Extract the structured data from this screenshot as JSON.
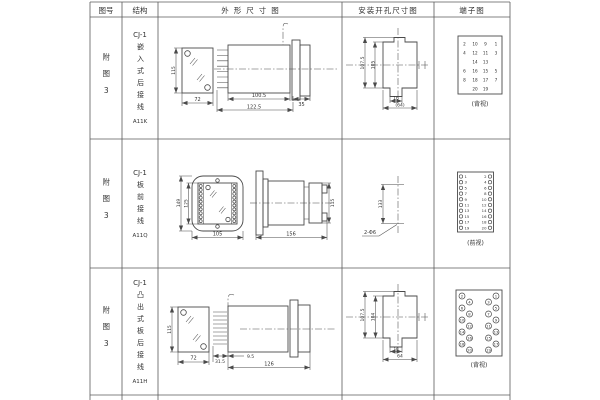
{
  "meta": {
    "background": "#ffffff",
    "line_color": "#4a4a4a",
    "text_color": "#333333"
  },
  "table": {
    "headers": [
      "图号",
      "结构",
      "外形尺寸图",
      "安装开孔尺寸图",
      "端子图"
    ],
    "rows": [
      {
        "fig_no": "附图3",
        "model": "CJ-1",
        "structure": "嵌入式后接线",
        "code": "A11K",
        "outline": {
          "front_height": "115",
          "front_width": "72",
          "body_length": "100.5",
          "total_length": "122.5",
          "flange_depth": "35"
        },
        "mounting": {
          "height_outer": "107.5",
          "height_inner": "105",
          "slot_width": "16",
          "opening_width": "(64)"
        },
        "terminal": {
          "view": "(背视)",
          "outer_left": [
            2,
            4,
            6,
            8
          ],
          "inner_left": [
            10,
            12,
            14,
            16,
            18,
            20
          ],
          "inner_right": [
            9,
            11,
            13,
            15,
            17,
            19
          ],
          "outer_right": [
            1,
            3,
            5,
            7
          ]
        }
      },
      {
        "fig_no": "附图3",
        "model": "CJ-1",
        "structure": "板前接线",
        "code": "A11Q",
        "outline": {
          "front_height_outer": "149",
          "front_height_inner": "125",
          "front_width": "105",
          "side_length": "156",
          "side_height": "115"
        },
        "mounting": {
          "hole_pitch": "133",
          "hole_label": "2-Φ6"
        },
        "terminal": {
          "view": "(前视)",
          "left": [
            1,
            3,
            5,
            7,
            9,
            11,
            13,
            15,
            17,
            19
          ],
          "right": [
            2,
            4,
            6,
            8,
            10,
            12,
            14,
            16,
            18,
            20
          ]
        }
      },
      {
        "fig_no": "附图3",
        "model": "CJ-1",
        "structure": "凸出式板后接线",
        "code": "A11H",
        "outline": {
          "front_height": "115",
          "front_width": "72",
          "terminal_depth": "31.5",
          "offset": "9.5",
          "body_length": "126"
        },
        "mounting": {
          "height_outer": "107.5",
          "height_inner": "104",
          "slot_width": "16",
          "opening_width": "64"
        },
        "terminal": {
          "view": "(背视)",
          "left": [
            2,
            4,
            6,
            8,
            10,
            12,
            14,
            16,
            18,
            20
          ],
          "right": [
            1,
            3,
            5,
            7,
            9,
            11,
            13,
            15,
            17,
            19
          ]
        }
      }
    ]
  }
}
